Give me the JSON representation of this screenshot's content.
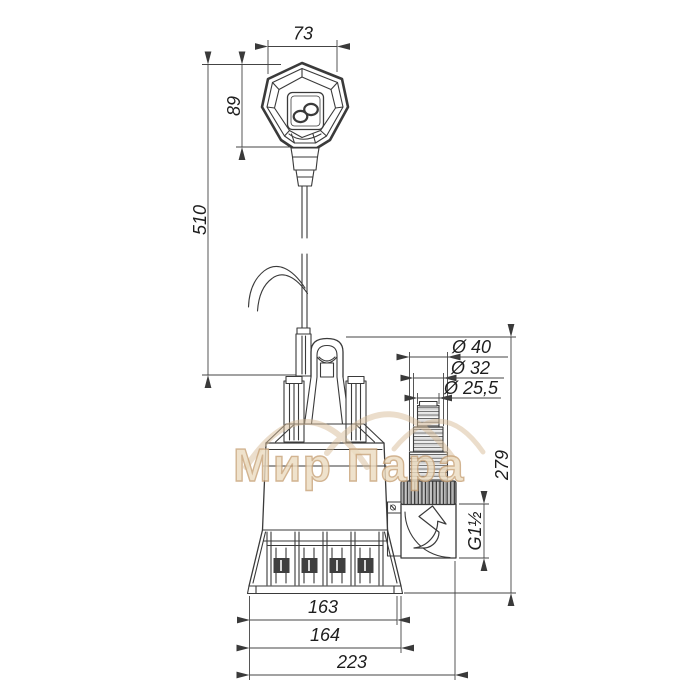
{
  "drawing": {
    "line_color": "#3a3a3a",
    "background": "#ffffff",
    "dimensions": {
      "float_width": "73",
      "float_height": "89",
      "cable_length": "510",
      "hose_step_1": "Ø 40",
      "hose_step_2": "Ø 32",
      "hose_step_3": "Ø 25,5",
      "pump_height": "279",
      "outlet_thread": "G1½",
      "base_width": "163",
      "base_plate_width": "164",
      "overall_width": "223"
    }
  },
  "watermark": {
    "text": "Мир Пара",
    "fill": "#ecdcc1",
    "outline": "#c9a47a",
    "arc_color": "#d8bd99"
  }
}
